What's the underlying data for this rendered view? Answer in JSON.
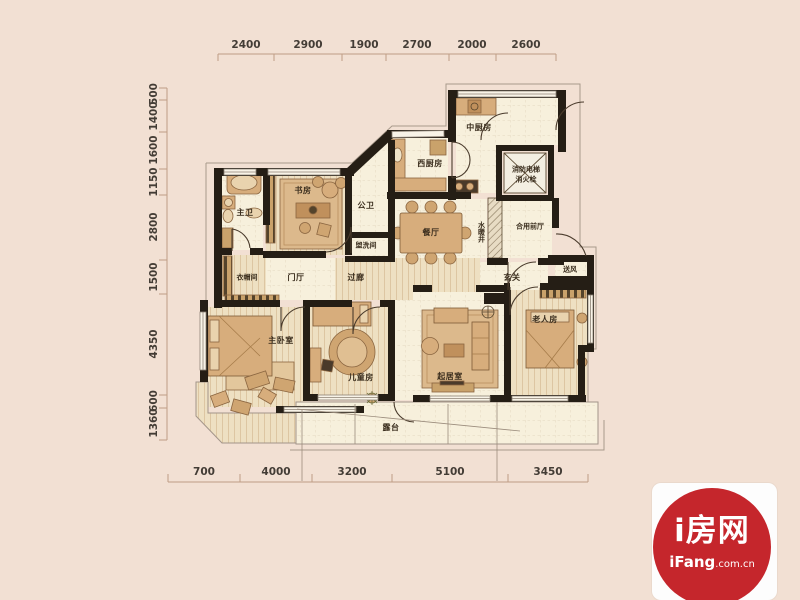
{
  "plan": {
    "rooms": {
      "master_bath": "主卫",
      "study": "书房",
      "public_bath": "公卫",
      "washroom": "盥洗间",
      "cloakroom": "衣帽间",
      "foyer": "门厅",
      "corridor": "过廊",
      "west_kitchen": "西厨房",
      "middle_kitchen": "中厨房",
      "fire_elevator": "消防电梯",
      "fire_hydrant": "消火栓",
      "dining": "餐厅",
      "utility_shaft": "水暖井",
      "shared_hall": "合用前厅",
      "entrance": "玄关",
      "air_supply": "送风",
      "master_bedroom": "主卧室",
      "children_room": "儿童房",
      "living_room": "起居室",
      "elderly_room": "老人房",
      "terrace": "露台"
    },
    "dimensions": {
      "top": [
        "2400",
        "2900",
        "1900",
        "2700",
        "2000",
        "2600"
      ],
      "left": [
        "500",
        "1400",
        "1600",
        "1150",
        "2800",
        "1500",
        "4350",
        "600",
        "1360"
      ],
      "bottom": [
        "700",
        "4000",
        "3200",
        "5100",
        "3450"
      ]
    }
  },
  "branding": {
    "site_name": "i房网",
    "domain_name": "iFang",
    "domain_suffix": ".com.cn"
  },
  "colors": {
    "background": "#f2e0d3",
    "wall": "#251e15",
    "floor_tile": "#f7f0dc",
    "floor_wood": "#eee0c2",
    "furniture_tan": "#d7ad7c",
    "dimension_line": "#bf9d85",
    "logo_red": "#c5262c",
    "logo_card": "#fdfdfd"
  }
}
